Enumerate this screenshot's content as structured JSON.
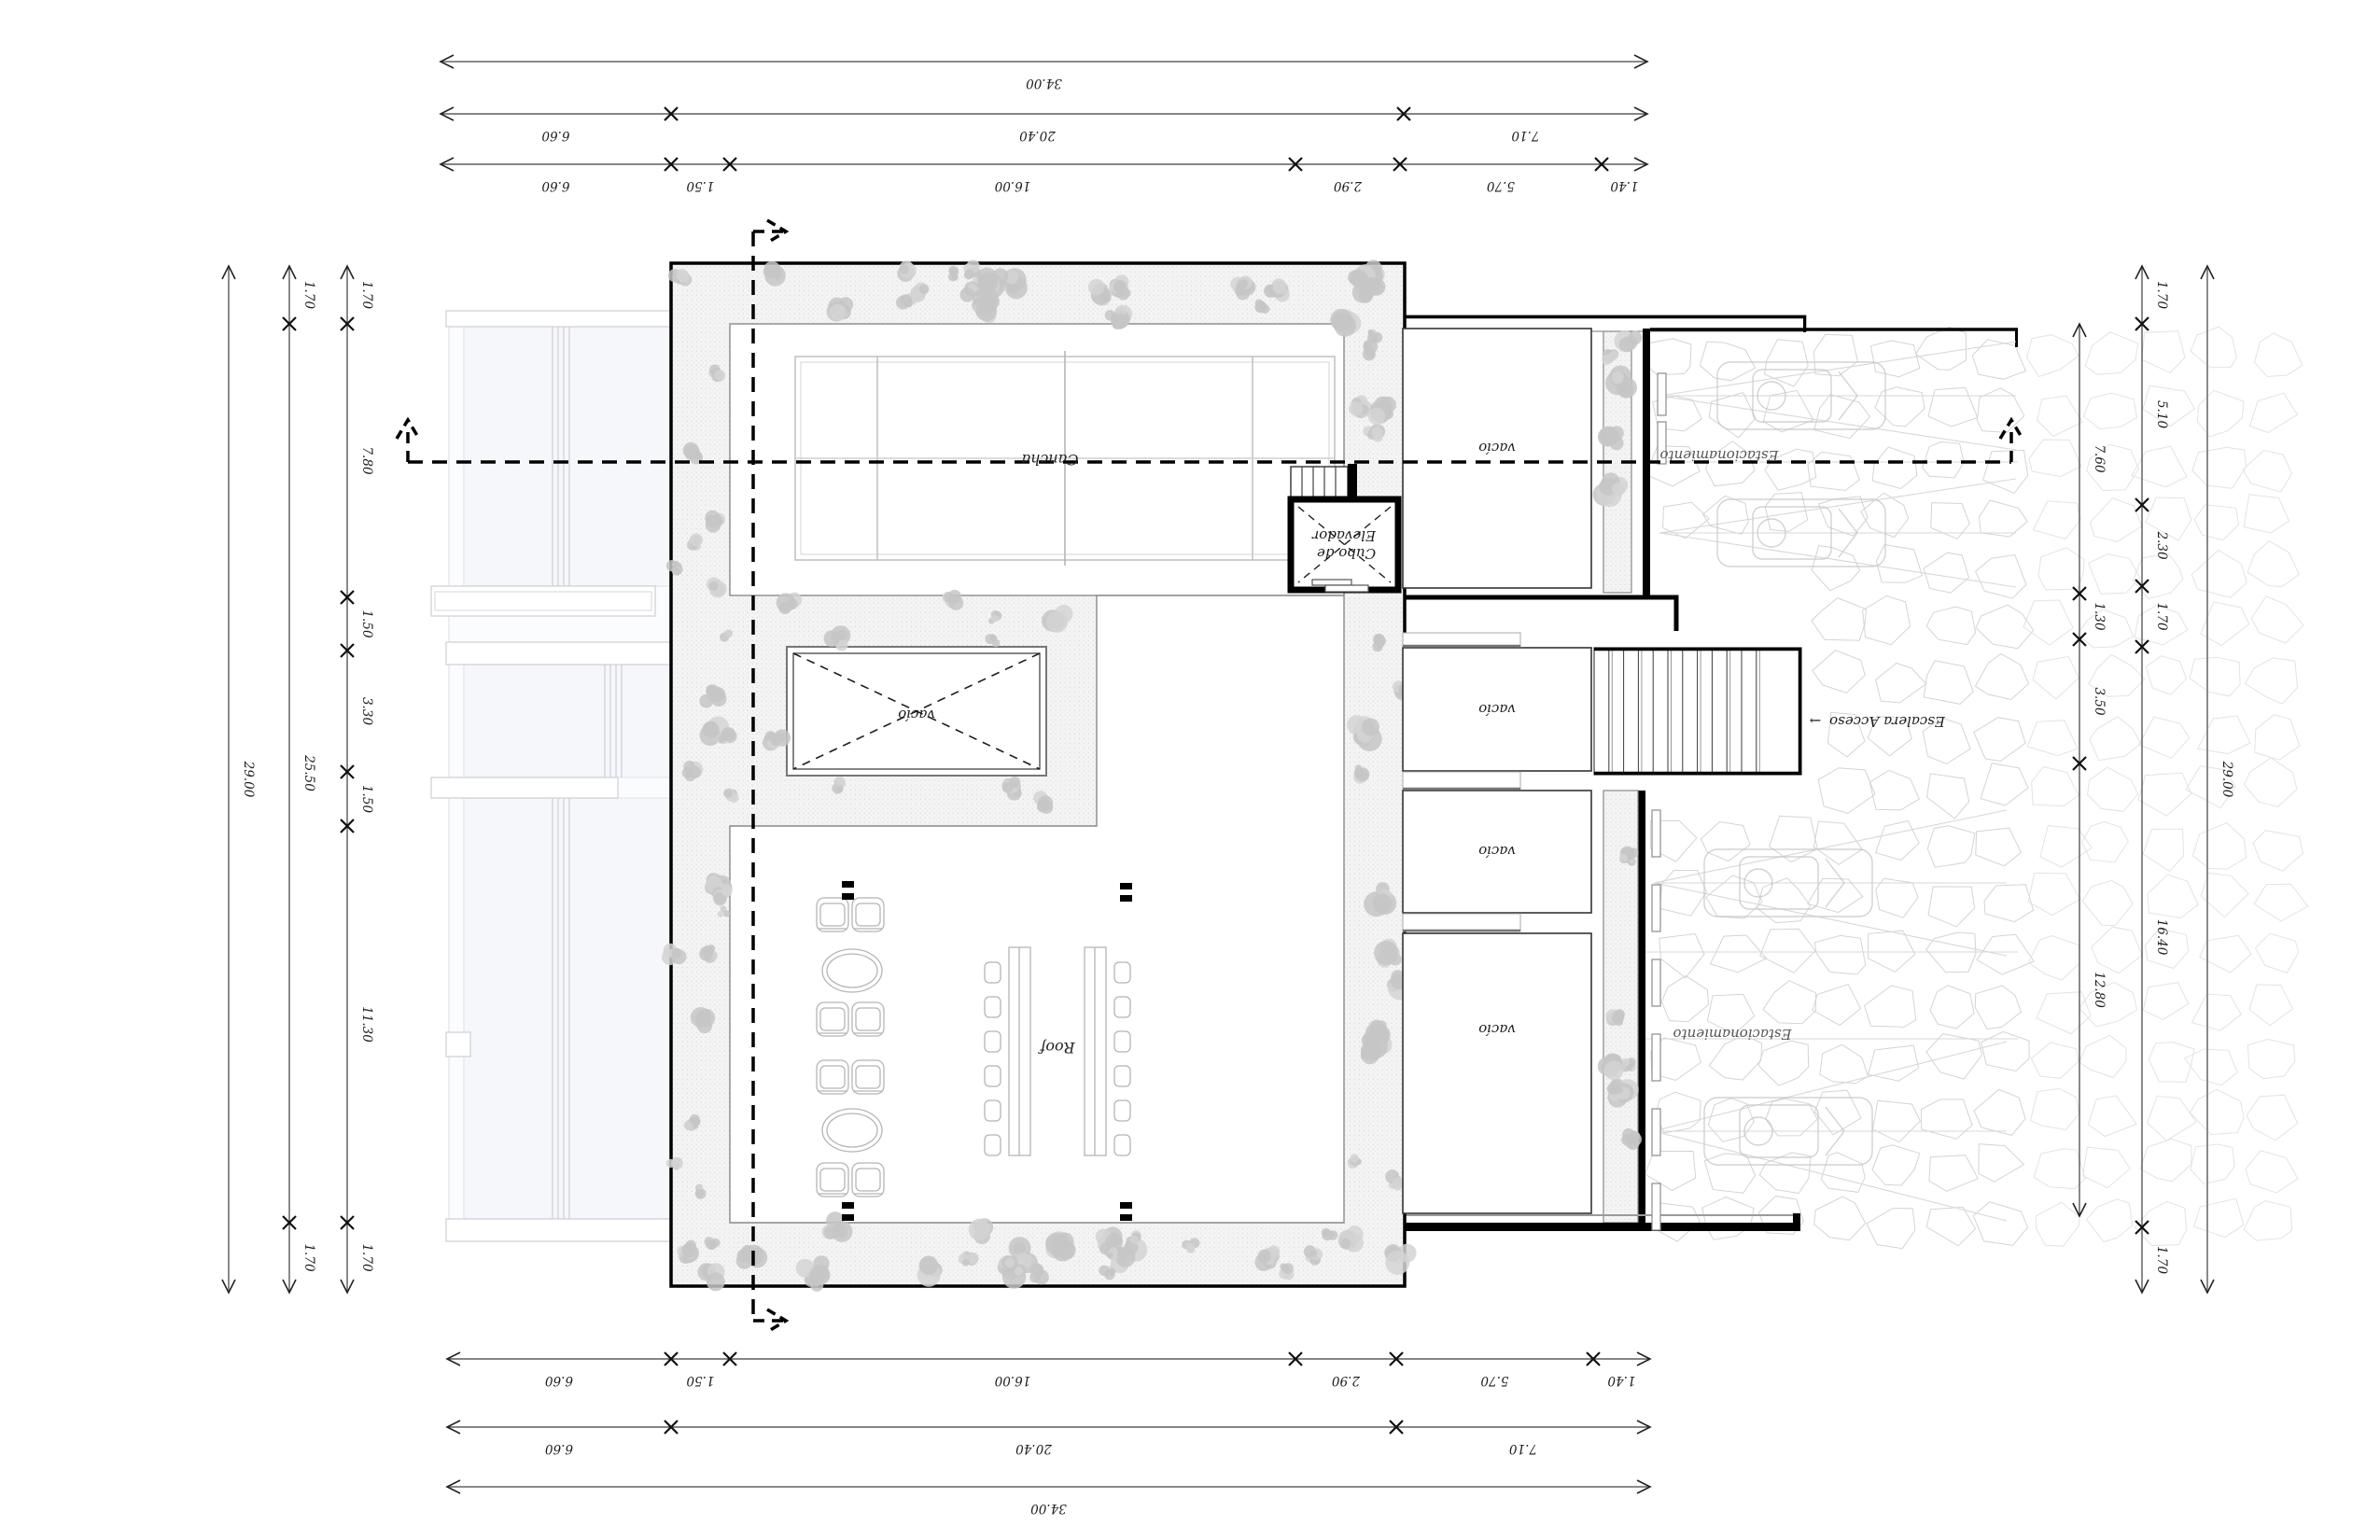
{
  "drawing": {
    "type": "architectural-roof-plan",
    "orientation": "rotated-180",
    "colors": {
      "line": "#000000",
      "ghost": "#c9c9cf",
      "vegetation": "#c6c6c6",
      "stone_joint": "#d6d6d6",
      "court_line": "#c3c3c3"
    }
  },
  "labels": {
    "cancha": "Cancha",
    "roof": "Roof",
    "vacio_patio_small": "vacío",
    "vacio_p1": "vacío",
    "vacio_p2": "vacío",
    "vacio_p3": "vacío",
    "vacio_p4": "vacío",
    "elevator_line1": "Cubo de",
    "elevator_line2": "Elevador",
    "estacionamiento_upper": "Estacionamiento",
    "estacionamiento_lower": "Estacionamiento",
    "escalera": "Escalera Acceso",
    "escalera_arrow": "→"
  },
  "dimensions": {
    "top": [
      [
        "34.00"
      ],
      [
        "6.60",
        "20.40",
        "7.10"
      ],
      [
        "6.60",
        "1.50",
        "16.00",
        "2.90",
        "5.70",
        "1.40"
      ]
    ],
    "bottom": [
      [
        "6.60",
        "1.50",
        "16.00",
        "2.90",
        "5.70",
        "1.40"
      ],
      [
        "6.60",
        "20.40",
        "7.10"
      ],
      [
        "34.00"
      ]
    ],
    "left": [
      [
        "29.00"
      ],
      [
        "1.70",
        "25.50",
        "1.70"
      ],
      [
        "1.70",
        "7.80",
        "1.50",
        "3.30",
        "1.50",
        "11.30",
        "1.70"
      ]
    ],
    "right": [
      [
        "7.60",
        "1.30",
        "3.50",
        "12.80"
      ],
      [
        "1.70",
        "5.10",
        "2.30",
        "1.70",
        "16.40",
        "1.70"
      ],
      [
        "29.00"
      ]
    ]
  }
}
